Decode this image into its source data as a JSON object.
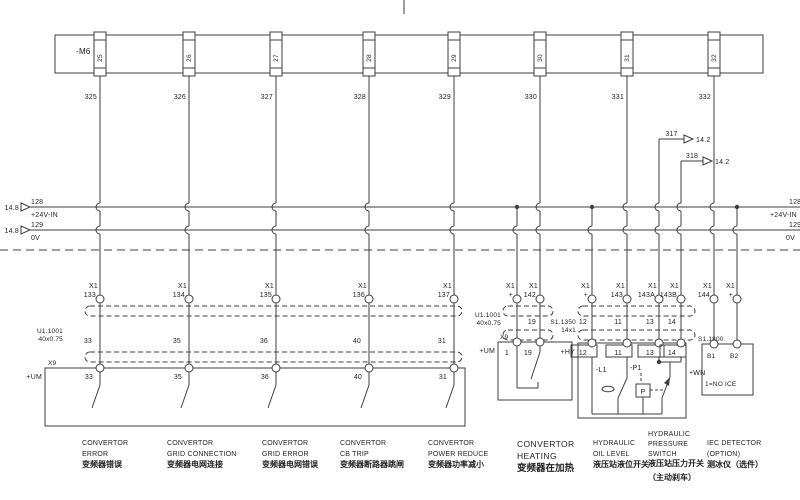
{
  "drawing": {
    "bg": "#ffffff",
    "ink": "#3e3e3e"
  },
  "top_block": {
    "label": "-M6",
    "terminals": [
      {
        "pin": "25",
        "wire_no": "325",
        "x": 100
      },
      {
        "pin": "26",
        "wire_no": "326",
        "x": 189
      },
      {
        "pin": "27",
        "wire_no": "327",
        "x": 276
      },
      {
        "pin": "28",
        "wire_no": "328",
        "x": 369
      },
      {
        "pin": "29",
        "wire_no": "329",
        "x": 454
      },
      {
        "pin": "30",
        "wire_no": "330",
        "x": 540
      },
      {
        "pin": "31",
        "wire_no": "331",
        "x": 627
      },
      {
        "pin": "32",
        "wire_no": "332",
        "x": 714
      }
    ]
  },
  "buses": [
    {
      "page_ref": "14.8",
      "wire_no": "128",
      "label": "+24V-IN",
      "right_wire_no": "128",
      "right_label": "+24V-IN",
      "y": 207
    },
    {
      "page_ref": "14.8",
      "wire_no": "129",
      "label": "0V",
      "right_wire_no": "129",
      "right_label": "0V",
      "y": 230
    }
  ],
  "branches": [
    {
      "wire_no": "317",
      "page_ref": "14.2",
      "x": 659,
      "y": 139,
      "arrow_x": 684
    },
    {
      "wire_no": "318",
      "page_ref": "14.2",
      "x": 681,
      "y": 161,
      "arrow_x": 703
    }
  ],
  "x1_terminals": [
    {
      "name": "X1",
      "pin": "133",
      "x": 100,
      "feed": "block"
    },
    {
      "name": "X1",
      "pin": "134",
      "x": 189,
      "feed": "block"
    },
    {
      "name": "X1",
      "pin": "135",
      "x": 276,
      "feed": "block"
    },
    {
      "name": "X1",
      "pin": "136",
      "x": 369,
      "feed": "block"
    },
    {
      "name": "X1",
      "pin": "137",
      "x": 454,
      "feed": "block"
    },
    {
      "name": "X1",
      "pin": "+",
      "x": 517,
      "feed": "bus"
    },
    {
      "name": "X1",
      "pin": "142",
      "x": 540,
      "feed": "block"
    },
    {
      "name": "X1",
      "pin": "+",
      "x": 592,
      "feed": "bus"
    },
    {
      "name": "X1",
      "pin": "143",
      "x": 627,
      "feed": "block"
    },
    {
      "name": "X1",
      "pin": "143A",
      "x": 659,
      "feed": "branch"
    },
    {
      "name": "X1",
      "pin": "143B",
      "x": 681,
      "feed": "branch"
    },
    {
      "name": "X1",
      "pin": "144",
      "x": 714,
      "feed": "block"
    },
    {
      "name": "X1",
      "pin": "+",
      "x": 737,
      "feed": "bus"
    }
  ],
  "cables": [
    {
      "label": "U1.1001",
      "spec": "40x0.75",
      "x1": 85,
      "x2": 462,
      "rows": [
        306,
        352
      ],
      "label_x": 63,
      "label_y": 333,
      "nums_y": 343,
      "wire_nos": [
        {
          "t": "33",
          "x": 92
        },
        {
          "t": "35",
          "x": 181
        },
        {
          "t": "36",
          "x": 268
        },
        {
          "t": "40",
          "x": 361
        },
        {
          "t": "31",
          "x": 446
        }
      ]
    },
    {
      "label": "U1.1001",
      "spec": "40x0.75",
      "x1": 503,
      "x2": 553,
      "rows": [
        306,
        330
      ],
      "label_x": 501,
      "label_y": 317,
      "nums_y": 324,
      "wire_nos": [
        {
          "t": "19",
          "x": 536
        }
      ]
    },
    {
      "label": "S1.1350",
      "spec": "14x1",
      "x1": 578,
      "x2": 695,
      "rows": [
        306,
        330
      ],
      "label_x": 576,
      "label_y": 324,
      "nums_y": 324,
      "wire_nos": [
        {
          "t": "12",
          "x": 587
        },
        {
          "t": "11",
          "x": 622
        },
        {
          "t": "13",
          "x": 654
        },
        {
          "t": "14",
          "x": 676
        }
      ]
    }
  ],
  "x9_box": {
    "label": "X9",
    "loc": "+UM",
    "pins": [
      {
        "x": 100,
        "num": "33"
      },
      {
        "x": 189,
        "num": "35"
      },
      {
        "x": 276,
        "num": "36"
      },
      {
        "x": 369,
        "num": "40"
      },
      {
        "x": 454,
        "num": "31"
      }
    ]
  },
  "heating_box": {
    "label": "X9",
    "loc": "+UM",
    "pins": [
      {
        "x": 517,
        "num": "1"
      },
      {
        "x": 540,
        "num": "19"
      }
    ]
  },
  "hydraulic_box": {
    "loc": "+HY",
    "loc_right": "+WN",
    "level_ref": "-L1",
    "pressure_ref": "-P1",
    "pressure_symbol": "P",
    "cells": [
      {
        "x": 592,
        "num": "12"
      },
      {
        "x": 627,
        "num": "11"
      },
      {
        "x": 659,
        "num": "13"
      },
      {
        "x": 681,
        "num": "14"
      }
    ]
  },
  "iec_box": {
    "label": "S1.1800",
    "note": "1=NO ICE",
    "pins": [
      {
        "x": 714,
        "num": "B1"
      },
      {
        "x": 737,
        "num": "B2"
      }
    ]
  },
  "captions": [
    {
      "x": 82,
      "en": [
        "CONVERTOR",
        "ERROR"
      ],
      "zh": [
        "变频器错误"
      ]
    },
    {
      "x": 167,
      "en": [
        "CONVERTOR",
        "GRID  CONNECTION"
      ],
      "zh": [
        "变频器电网连接"
      ]
    },
    {
      "x": 262,
      "en": [
        "CONVERTOR",
        "GRID  ERROR"
      ],
      "zh": [
        "变频器电网错误"
      ]
    },
    {
      "x": 340,
      "en": [
        "CONVERTOR",
        "CB  TRIP"
      ],
      "zh": [
        "变频器断路器跳闸"
      ]
    },
    {
      "x": 428,
      "en": [
        "CONVERTOR",
        "POWER  REDUCE"
      ],
      "zh": [
        "变频器功率减小"
      ]
    },
    {
      "x": 517,
      "en": [
        "CONVERTOR",
        "HEATING"
      ],
      "zh": [
        "变频器在加热"
      ],
      "style": "big"
    },
    {
      "x": 593,
      "en": [
        "HYDRAULIC",
        "OIL  LEVEL"
      ],
      "zh": [
        "液压站液位开关"
      ]
    },
    {
      "x": 648,
      "en": [
        "HYDRAULIC",
        "PRESSURE",
        "SWITCH"
      ],
      "zh": [
        "液压站压力开关",
        "（主动刹车）"
      ],
      "style": "tall"
    },
    {
      "x": 707,
      "en": [
        "IEC  DETECTOR",
        "(OPTION)"
      ],
      "zh": [
        "测冰仪（选件）"
      ]
    }
  ]
}
